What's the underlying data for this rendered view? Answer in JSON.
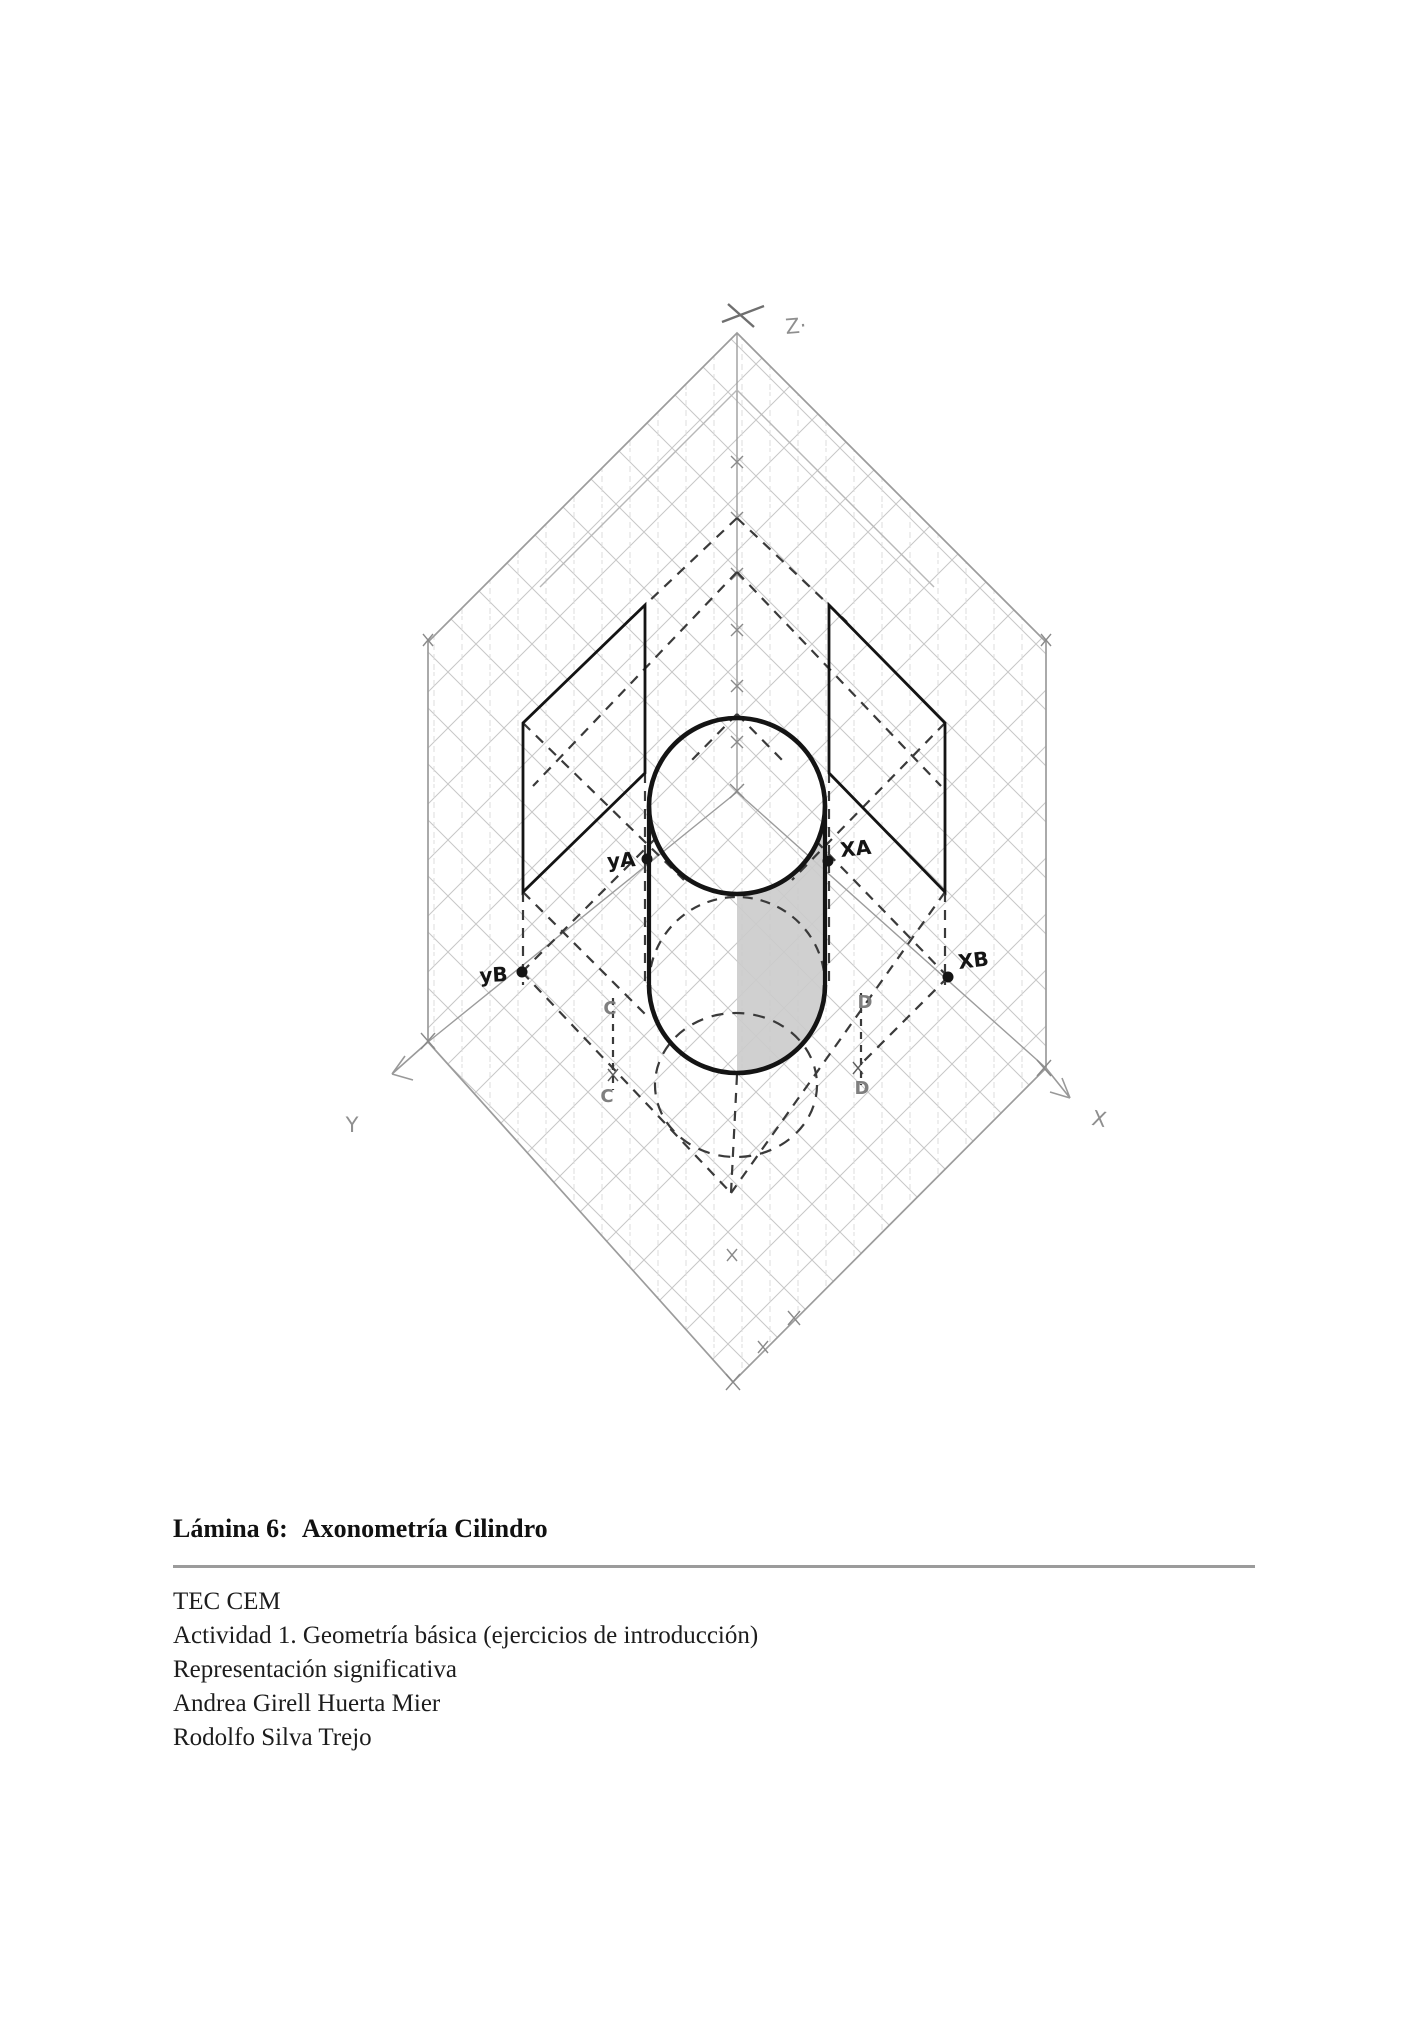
{
  "page": {
    "background": "#ffffff"
  },
  "figure": {
    "description": "hand-drawn axonometric construction of a cylinder on an isometric pencil grid",
    "axis_labels": {
      "z": "Z·",
      "y": "Y",
      "x": "X"
    },
    "point_labels": {
      "ya": "yA",
      "xa": "XA",
      "yb": "yB",
      "xb": "XB",
      "c_upper": "C",
      "c_lower": "C",
      "d_upper": "D",
      "d_lower": "D"
    },
    "colors": {
      "ink": "#141414",
      "pencil": "#9c9c9c",
      "grid": "#bdbdbd",
      "dashed": "#3a3a3a",
      "shading": "#cbcbcb",
      "gray_label": "#7f7f7f"
    }
  },
  "caption": {
    "label": "Lámina 6:",
    "title": "Axonometría Cilindro"
  },
  "footer": {
    "lines": [
      "TEC CEM",
      "Actividad 1. Geometría básica (ejercicios de introducción)",
      "Representación significativa",
      "Andrea Girell Huerta Mier",
      "Rodolfo Silva Trejo"
    ]
  }
}
